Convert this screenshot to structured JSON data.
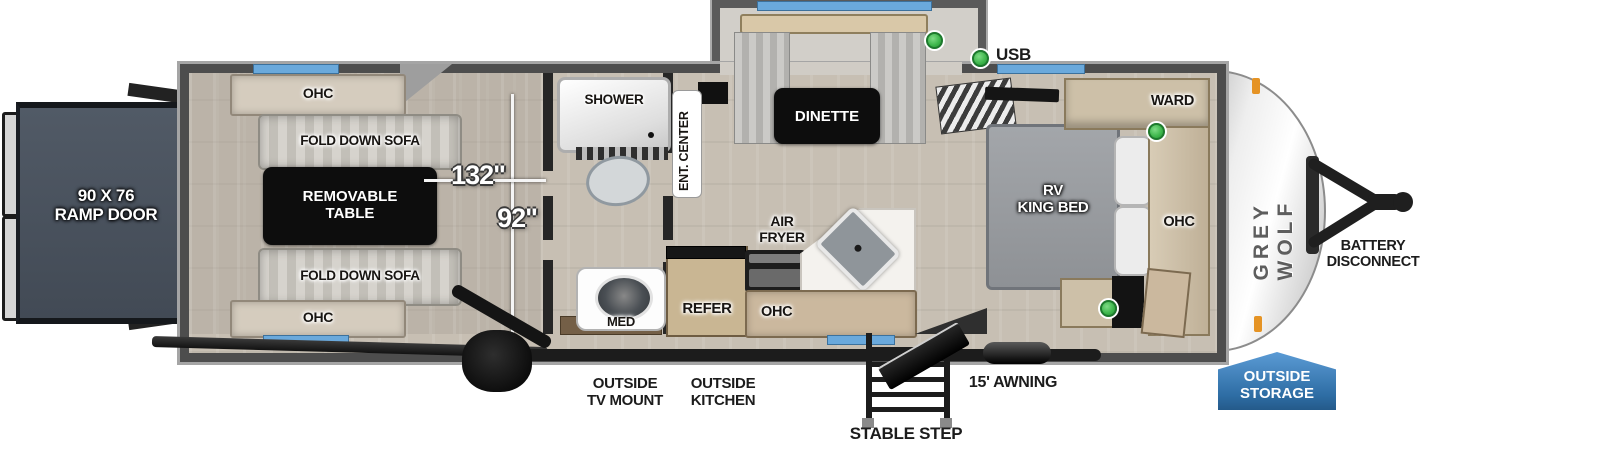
{
  "legend": {
    "usb": "USB"
  },
  "exterior": {
    "ramp_door": "90 X 76\nRAMP DOOR",
    "battery_disconnect": "BATTERY\nDISCONNECT",
    "outside_storage": "OUTSIDE\nSTORAGE",
    "outside_tv_mount": "OUTSIDE\nTV MOUNT",
    "outside_kitchen": "OUTSIDE\nKITCHEN",
    "stable_step": "STABLE STEP",
    "awning": "15' AWNING",
    "brand": "GREY WOLF"
  },
  "garage": {
    "ohc_top": "OHC",
    "ohc_bottom": "OHC",
    "sofa_top": "FOLD DOWN SOFA",
    "sofa_bottom": "FOLD DOWN SOFA",
    "removable_table": "REMOVABLE\nTABLE",
    "dim_length": "132\"",
    "dim_width": "92\""
  },
  "bathroom": {
    "shower": "SHOWER",
    "med": "MED"
  },
  "living": {
    "ent_center": "ENT. CENTER",
    "dinette": "DINETTE"
  },
  "kitchen": {
    "air_fryer": "AIR\nFRYER",
    "refer": "REFER",
    "ohc": "OHC"
  },
  "bedroom": {
    "bed": "RV\nKING BED",
    "ward": "WARD",
    "ohc": "OHC"
  },
  "colors": {
    "window_blue": "#6aa9dc",
    "badge_blue": "#2e6da4",
    "usb_green": "#3cb54a",
    "ramp_gray": "#49525e",
    "wall_gray": "#4d4d4d",
    "floor_tan": "#c7bfb3"
  }
}
